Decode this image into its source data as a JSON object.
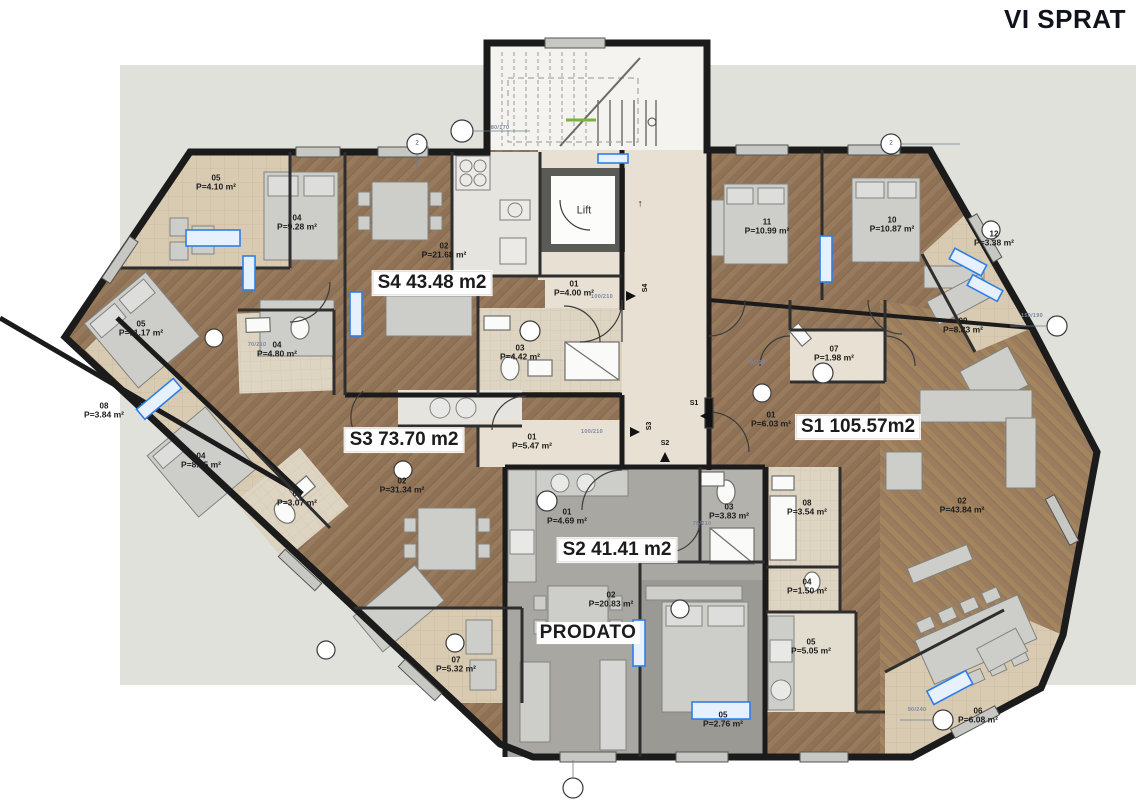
{
  "title": "VI SPRAT",
  "common": {
    "lift_label": "Lift",
    "up_arrow": "↑"
  },
  "units": [
    {
      "id": "S1",
      "label": "S1 105.57m2"
    },
    {
      "id": "S2",
      "label": "S2 41.41 m2",
      "status": "PRODATO"
    },
    {
      "id": "S3",
      "label": "S3 73.70 m2"
    },
    {
      "id": "S4",
      "label": "S4 43.48 m2"
    }
  ],
  "rooms": [
    {
      "num": "05",
      "area": "P=4.10 m²"
    },
    {
      "num": "04",
      "area": "P=9.28 m²"
    },
    {
      "num": "02",
      "area": "P=21.68 m²"
    },
    {
      "num": "05",
      "area": "P=11.17 m²"
    },
    {
      "num": "04",
      "area": "P=4.80 m²"
    },
    {
      "num": "03",
      "area": "P=4.42 m²"
    },
    {
      "num": "01",
      "area": "P=4.00 m²"
    },
    {
      "num": "08",
      "area": "P=3.84 m²"
    },
    {
      "num": "04",
      "area": "P=8.75 m²"
    },
    {
      "num": "03",
      "area": "P=3.07 m²"
    },
    {
      "num": "02",
      "area": "P=31.34 m²"
    },
    {
      "num": "01",
      "area": "P=5.47 m²"
    },
    {
      "num": "07",
      "area": "P=5.32 m²"
    },
    {
      "num": "11",
      "area": "P=10.99 m²"
    },
    {
      "num": "10",
      "area": "P=10.87 m²"
    },
    {
      "num": "12",
      "area": "P=3.38 m²"
    },
    {
      "num": "09",
      "area": "P=8.83 m²"
    },
    {
      "num": "07",
      "area": "P=1.98 m²"
    },
    {
      "num": "01",
      "area": "P=6.03 m²"
    },
    {
      "num": "01",
      "area": "P=4.69 m²"
    },
    {
      "num": "03",
      "area": "P=3.83 m²"
    },
    {
      "num": "08",
      "area": "P=3.54 m²"
    },
    {
      "num": "02",
      "area": "P=43.84 m²"
    },
    {
      "num": "02",
      "area": "P=20.83 m²"
    },
    {
      "num": "04",
      "area": "P=1.50 m²"
    },
    {
      "num": "05",
      "area": "P=5.05 m²"
    },
    {
      "num": "05",
      "area": "P=2.76 m²"
    },
    {
      "num": "06",
      "area": "P=6.08 m²"
    }
  ],
  "entry_markers": [
    "S4",
    "S3",
    "S2",
    "S1"
  ],
  "dims": [
    "80/170",
    "100/210",
    "70/210",
    "75/210",
    "150/190",
    "90/240",
    "100/210",
    "75/210"
  ],
  "grid_bubbles": [
    "2",
    "2"
  ],
  "colors": {
    "site_bg": "#e0e1db",
    "wood": "#8f7155",
    "wood_light": "#a1825f",
    "terrace": "#d9cbb2",
    "bath": "#ded4c2",
    "corridor": "#e8e1d3",
    "s2_gray": "#a9a7a2",
    "wall": "#1b1b1b",
    "accent_blue": "#2f7fe8",
    "furniture": "#cbcbc8"
  }
}
